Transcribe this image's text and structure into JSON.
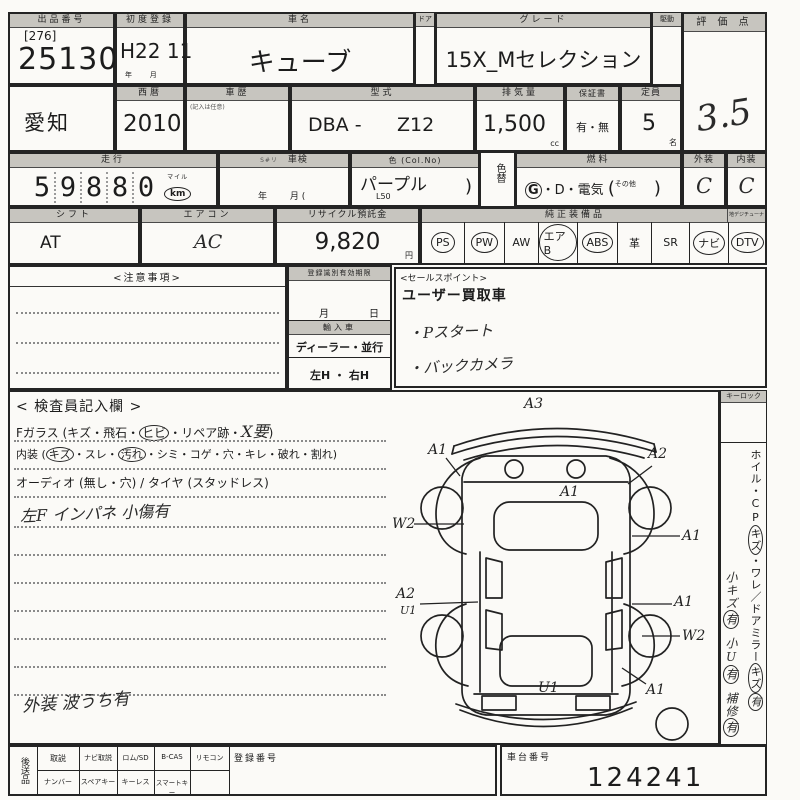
{
  "header": {
    "lot_label": "出品番号",
    "lot_bracket": "[276]",
    "lot_number": "25130",
    "firstreg_label": "初度登録",
    "firstreg": "H22 11",
    "firstreg_units": "年        月",
    "name_label": "車名",
    "car_name": "キューブ",
    "door_label": "ドア",
    "grade_label": "グレード",
    "grade": "15X_Mセレクション",
    "drive_label": "駆動",
    "score_label": "評 価 点",
    "score": "3.5",
    "region": "愛知",
    "year_label": "西暦",
    "year": "2010",
    "history_label": "車歴",
    "history_note": "(記入は任意)",
    "model_label": "型式",
    "model_prefix": "DBA -",
    "model_code": "Z12",
    "disp_label": "排気量",
    "displacement": "1,500",
    "disp_unit": "cc",
    "warranty_label": "保証書",
    "warranty": "有・無",
    "capacity_label": "定員",
    "capacity": "5",
    "capacity_unit": "名",
    "ext_label": "外装",
    "ext_grade": "C",
    "int_label": "内装",
    "int_grade": "C"
  },
  "row2": {
    "mileage_label": "走行",
    "mileage_digits": [
      "5",
      "9",
      "8",
      "8",
      "0"
    ],
    "mile_badge_top": "マイル",
    "mile_badge": "km",
    "meter_note": "S#リ",
    "shaken_label": "車検",
    "shaken_units": "年        月 (",
    "color_label": "色 (Col.No)",
    "color": "パープル",
    "color_code": "L50",
    "color_paren": ")",
    "colorchg_label": "色替",
    "fuel_label": "燃料",
    "fuel_g": "G",
    "fuel_rest": "・D・電気",
    "fuel_open": "(",
    "fuel_other": "その他",
    "fuel_close": ")"
  },
  "row3": {
    "shift_label": "シフト",
    "shift": "AT",
    "ac_label": "エアコン",
    "ac": "AC",
    "recycle_label": "リサイクル預託金",
    "recycle": "9,820",
    "recycle_unit": "円",
    "equip_label": "純正装備品",
    "tuner_label": "地デジチューナー",
    "equipment": [
      {
        "label": "PS",
        "circled": true
      },
      {
        "label": "PW",
        "circled": true
      },
      {
        "label": "AW",
        "circled": false
      },
      {
        "label": "エアB",
        "circled": true
      },
      {
        "label": "ABS",
        "circled": true
      },
      {
        "label": "革",
        "circled": false
      },
      {
        "label": "SR",
        "circled": false
      },
      {
        "label": "ナビ",
        "circled": true
      },
      {
        "label": "DTV",
        "circled": true
      }
    ]
  },
  "notes": {
    "label": "<注意事項>"
  },
  "registration": {
    "label": "登録識別有効期限",
    "month": "月",
    "day": "日",
    "import_label": "輸入車",
    "import_options": "ディーラー・並行",
    "handle": "左H ・ 右H"
  },
  "sales_points": {
    "label": "<セールスポイント>",
    "printed": "ユーザー買取車",
    "hand1": "・Pスタート",
    "hand2": "・バックカメラ"
  },
  "inspector": {
    "title": "< 検査員記入欄 >",
    "glass_pre": "Fガラス (キズ・飛石・",
    "glass_circled": "ヒビ",
    "glass_mid": "・リペア跡・",
    "glass_hand": "X要",
    "glass_close": ")",
    "int_pre": "内装 (",
    "int_c1": "キズ",
    "int_mid1": "・スレ・",
    "int_c2": "汚れ",
    "int_rest": "・シミ・コゲ・穴・キレ・破れ・割れ)",
    "audio_line": "オーディオ (無し・穴) / タイヤ (スタッドレス)",
    "hand_note1": "左F インパネ 小傷有",
    "hand_note2": "外装 波うち有"
  },
  "diagram": {
    "labels": [
      "A3",
      "A1",
      "A2",
      "A1",
      "W2",
      "A1",
      "A2",
      "U1",
      "A1",
      "W2",
      "A1",
      "U1"
    ]
  },
  "right_margin": {
    "keylock": "キーロック",
    "printed_1": "ホイル・CP",
    "printed_c1": "キズ",
    "printed_2": "・ワレ／ドアミラー",
    "printed_c2": "キズ",
    "printed_hand_end": "有",
    "hand_1": "小キズ",
    "hand_1c": "有",
    "hand_2": "小U",
    "hand_2c": "有",
    "hand_3": "補修",
    "hand_3c": "有"
  },
  "footer": {
    "send_label": "後送品",
    "row1": [
      "取説",
      "ナビ取説",
      "ロム/SD",
      "B-CAS",
      "リモコン"
    ],
    "row2": [
      "ナンバー",
      "スペアキー",
      "キーレス",
      "スマートキー"
    ],
    "regno_label": "登録番号",
    "chassis_label": "車台番号",
    "chassis_number": "124241"
  }
}
